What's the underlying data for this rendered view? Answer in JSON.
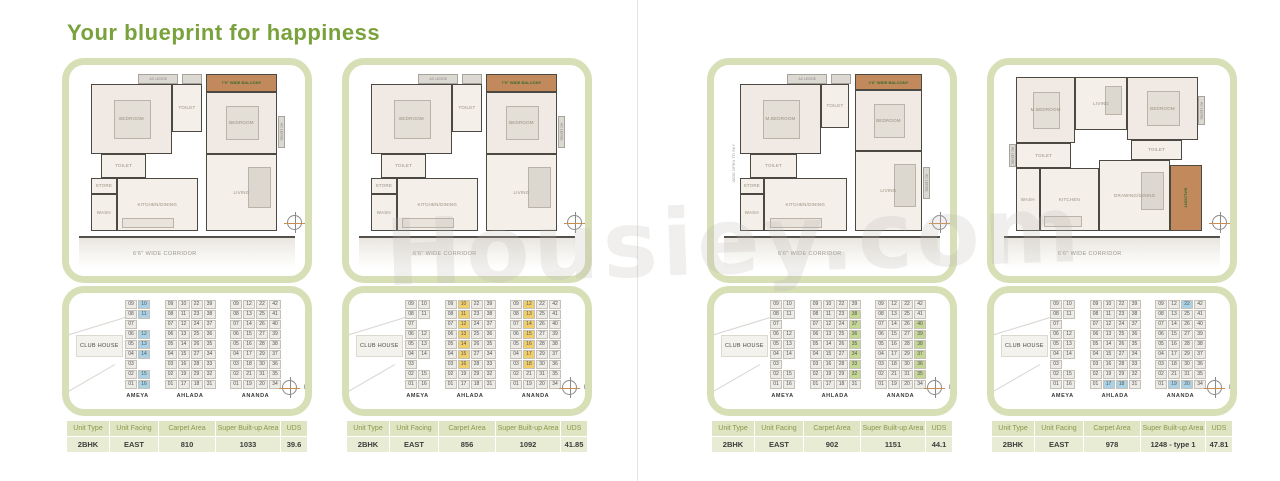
{
  "page": {
    "title": "Your blueprint for happiness",
    "watermark": "Housiey.com"
  },
  "table_headers": [
    "Unit Type",
    "Unit Facing",
    "Carpet Area",
    "Super Built-up Area",
    "UDS"
  ],
  "site_layout": {
    "clubhouse": "CLUB HOUSE",
    "towers": [
      {
        "name": "AMEYA",
        "cols": [
          [
            "09",
            "08",
            "07",
            "06",
            "05",
            "04",
            "03",
            "02",
            "01"
          ],
          [
            "10",
            "11",
            "",
            "12",
            "13",
            "14",
            "",
            "15",
            "16"
          ]
        ]
      },
      {
        "name": "AHLADA",
        "cols": [
          [
            "09",
            "08",
            "07",
            "06",
            "05",
            "04",
            "03",
            "02",
            "01"
          ],
          [
            "10",
            "11",
            "12",
            "13",
            "14",
            "15",
            "16",
            "19",
            "17"
          ],
          [
            "22",
            "23",
            "24",
            "25",
            "26",
            "27",
            "28",
            "29",
            "18"
          ],
          [
            "39",
            "38",
            "37",
            "36",
            "35",
            "34",
            "33",
            "32",
            "31"
          ]
        ]
      },
      {
        "name": "ANANDA",
        "cols": [
          [
            "09",
            "08",
            "07",
            "06",
            "05",
            "04",
            "03",
            "02",
            "01"
          ],
          [
            "12",
            "13",
            "14",
            "15",
            "16",
            "17",
            "18",
            "21",
            "19"
          ],
          [
            "22",
            "25",
            "26",
            "27",
            "28",
            "29",
            "30",
            "31",
            "20"
          ],
          [
            "42",
            "41",
            "40",
            "39",
            "38",
            "37",
            "36",
            "35",
            "34"
          ]
        ]
      }
    ]
  },
  "cards": [
    {
      "corridor": "6'6\" WIDE CORRIDOR",
      "compass": "N",
      "plan": {
        "rooms": [
          {
            "t": "ledge",
            "l": "AC LEDGE",
            "x": 26,
            "y": 0,
            "w": 20,
            "h": 6
          },
          {
            "t": "ledge",
            "l": "",
            "x": 48,
            "y": 0,
            "w": 10,
            "h": 6
          },
          {
            "t": "balcony",
            "l": "7'0\" WIDE BALCONY",
            "x": 60,
            "y": 0,
            "w": 36,
            "h": 11
          },
          {
            "t": "room",
            "c": "bedroom",
            "l": "BEDROOM",
            "x": 2,
            "y": 6,
            "w": 41,
            "h": 44
          },
          {
            "t": "room",
            "l": "TOILET",
            "x": 43,
            "y": 6,
            "w": 15,
            "h": 30
          },
          {
            "t": "room",
            "c": "bedroom",
            "l": "BEDROOM",
            "x": 60,
            "y": 11,
            "w": 36,
            "h": 39
          },
          {
            "t": "room",
            "l": "TOILET",
            "x": 7,
            "y": 50,
            "w": 23,
            "h": 15
          },
          {
            "t": "room",
            "l": "STORE",
            "x": 2,
            "y": 65,
            "w": 13,
            "h": 10
          },
          {
            "t": "room",
            "l": "WASH",
            "x": 2,
            "y": 75,
            "w": 13,
            "h": 23
          },
          {
            "t": "room",
            "c": "kitchen",
            "l": "KITCHEN/DINING",
            "x": 15,
            "y": 65,
            "w": 41,
            "h": 33
          },
          {
            "t": "room",
            "c": "living",
            "l": "LIVING",
            "x": 60,
            "y": 50,
            "w": 36,
            "h": 48
          },
          {
            "t": "vledge",
            "l": "AC LEDGE",
            "x": 96.5,
            "y": 26,
            "w": 3.5,
            "h": 20
          }
        ]
      },
      "site": {
        "highlight_color": "#a9d2e6",
        "highlights": [
          "AMEYA:10",
          "AMEYA:11",
          "AMEYA:12",
          "AMEYA:13",
          "AMEYA:14",
          "AMEYA:15",
          "AMEYA:16"
        ]
      },
      "table": [
        "2BHK",
        "EAST",
        "810",
        "1033",
        "39.6"
      ]
    },
    {
      "corridor": "6'6\" WIDE CORRIDOR",
      "compass": "N",
      "plan": {
        "rooms": [
          {
            "t": "ledge",
            "l": "AC LEDGE",
            "x": 26,
            "y": 0,
            "w": 20,
            "h": 6
          },
          {
            "t": "ledge",
            "l": "",
            "x": 48,
            "y": 0,
            "w": 10,
            "h": 6
          },
          {
            "t": "balcony",
            "l": "7'0\" WIDE BALCONY",
            "x": 60,
            "y": 0,
            "w": 36,
            "h": 11
          },
          {
            "t": "room",
            "c": "bedroom",
            "l": "BEDROOM",
            "x": 2,
            "y": 6,
            "w": 41,
            "h": 44
          },
          {
            "t": "room",
            "l": "TOILET",
            "x": 43,
            "y": 6,
            "w": 15,
            "h": 30
          },
          {
            "t": "room",
            "c": "bedroom",
            "l": "BEDROOM",
            "x": 60,
            "y": 11,
            "w": 36,
            "h": 39
          },
          {
            "t": "room",
            "l": "TOILET",
            "x": 7,
            "y": 50,
            "w": 23,
            "h": 15
          },
          {
            "t": "room",
            "l": "STORE",
            "x": 2,
            "y": 65,
            "w": 13,
            "h": 10
          },
          {
            "t": "room",
            "l": "WASH",
            "x": 2,
            "y": 75,
            "w": 13,
            "h": 23
          },
          {
            "t": "room",
            "c": "kitchen",
            "l": "KITCHEN/DINING",
            "x": 15,
            "y": 65,
            "w": 41,
            "h": 33
          },
          {
            "t": "room",
            "c": "living",
            "l": "LIVING",
            "x": 60,
            "y": 50,
            "w": 36,
            "h": 48
          },
          {
            "t": "vledge",
            "l": "AC LEDGE",
            "x": 96.5,
            "y": 26,
            "w": 3.5,
            "h": 20
          }
        ]
      },
      "site": {
        "highlight_color": "#f0cf6a",
        "highlights": [
          "AHLADA:10",
          "AHLADA:11",
          "AHLADA:12",
          "AHLADA:13",
          "AHLADA:14",
          "AHLADA:15",
          "AHLADA:16",
          "ANANDA:12",
          "ANANDA:13",
          "ANANDA:14",
          "ANANDA:15",
          "ANANDA:16",
          "ANANDA:17",
          "ANANDA:18"
        ]
      },
      "table": [
        "2BHK",
        "EAST",
        "856",
        "1092",
        "41.85"
      ]
    },
    {
      "corridor": "6'6\" WIDE CORRIDOR",
      "compass": "N",
      "plan": {
        "rooms": [
          {
            "t": "ledge",
            "l": "AC LEDGE",
            "x": 28,
            "y": 0,
            "w": 20,
            "h": 6
          },
          {
            "t": "ledge",
            "l": "",
            "x": 50,
            "y": 0,
            "w": 10,
            "h": 6
          },
          {
            "t": "balcony",
            "l": "2'6\" WIDE BALCONY",
            "x": 62,
            "y": 0,
            "w": 34,
            "h": 10
          },
          {
            "t": "room",
            "c": "bedroom",
            "l": "M.BEDROOM",
            "x": 4,
            "y": 6,
            "w": 41,
            "h": 44
          },
          {
            "t": "room",
            "l": "TOILET",
            "x": 45,
            "y": 6,
            "w": 14,
            "h": 28
          },
          {
            "t": "room",
            "c": "bedroom",
            "l": "BEDROOM",
            "x": 62,
            "y": 10,
            "w": 34,
            "h": 38
          },
          {
            "t": "room",
            "l": "TOILET",
            "x": 9,
            "y": 50,
            "w": 24,
            "h": 15
          },
          {
            "t": "room",
            "l": "STORE",
            "x": 4,
            "y": 65,
            "w": 12,
            "h": 10
          },
          {
            "t": "room",
            "l": "WASH",
            "x": 4,
            "y": 75,
            "w": 12,
            "h": 23
          },
          {
            "t": "room",
            "c": "kitchen",
            "l": "KITCHEN/DINING",
            "x": 16,
            "y": 65,
            "w": 42,
            "h": 33
          },
          {
            "t": "room",
            "c": "living",
            "l": "LIVING",
            "x": 62,
            "y": 48,
            "w": 34,
            "h": 50
          },
          {
            "t": "vledge",
            "l": "AC LEDGE",
            "x": 96.5,
            "y": 58,
            "w": 3.5,
            "h": 20
          },
          {
            "t": "sky",
            "l": "WIDE OPEN TO SKY",
            "x": -1,
            "y": 28,
            "w": 4,
            "h": 55
          }
        ]
      },
      "site": {
        "highlight_color": "#c5d795",
        "highlights": [
          "AHLADA:32",
          "AHLADA:33",
          "AHLADA:34",
          "AHLADA:35",
          "AHLADA:36",
          "AHLADA:37",
          "AHLADA:38",
          "ANANDA:35",
          "ANANDA:36",
          "ANANDA:37",
          "ANANDA:38",
          "ANANDA:39",
          "ANANDA:40"
        ]
      },
      "table": [
        "2BHK",
        "EAST",
        "902",
        "1151",
        "44.1"
      ]
    },
    {
      "corridor": "6'6\" WIDE CORRIDOR",
      "compass": "N",
      "plan": {
        "rooms": [
          {
            "t": "room",
            "c": "bedroom",
            "l": "M.BEDROOM",
            "x": 2,
            "y": 2,
            "w": 30,
            "h": 41
          },
          {
            "t": "room",
            "c": "living",
            "l": "LIVING",
            "x": 32,
            "y": 2,
            "w": 26,
            "h": 33
          },
          {
            "t": "room",
            "c": "bedroom",
            "l": "BEDROOM",
            "x": 58,
            "y": 2,
            "w": 36,
            "h": 39
          },
          {
            "t": "room",
            "l": "TOILET",
            "x": 2,
            "y": 43,
            "w": 28,
            "h": 16
          },
          {
            "t": "room",
            "l": "TOILET",
            "x": 60,
            "y": 41,
            "w": 26,
            "h": 13
          },
          {
            "t": "room",
            "l": "WASH",
            "x": 2,
            "y": 59,
            "w": 12,
            "h": 39
          },
          {
            "t": "room",
            "c": "kitchen",
            "l": "KITCHEN",
            "x": 14,
            "y": 59,
            "w": 30,
            "h": 39
          },
          {
            "t": "room",
            "c": "living",
            "l": "DRAWING/DINING",
            "x": 44,
            "y": 54,
            "w": 36,
            "h": 44
          },
          {
            "t": "balcony",
            "c": "vert",
            "l": "BALCONY",
            "x": 80,
            "y": 57,
            "w": 16,
            "h": 41
          },
          {
            "t": "vledge",
            "l": "AC LEDGE",
            "x": 94,
            "y": 14,
            "w": 3.5,
            "h": 18
          },
          {
            "t": "vledge",
            "l": "AC LEDGE",
            "x": -1.5,
            "y": 44,
            "w": 3.5,
            "h": 14
          }
        ]
      },
      "site": {
        "highlight_color": "#a9d2e6",
        "highlights": [
          "AHLADA:17",
          "AHLADA:18",
          "ANANDA:22",
          "ANANDA:19",
          "ANANDA:20"
        ]
      },
      "table": [
        "2BHK",
        "EAST",
        "978",
        "1248 - type 1",
        "47.81"
      ]
    }
  ]
}
